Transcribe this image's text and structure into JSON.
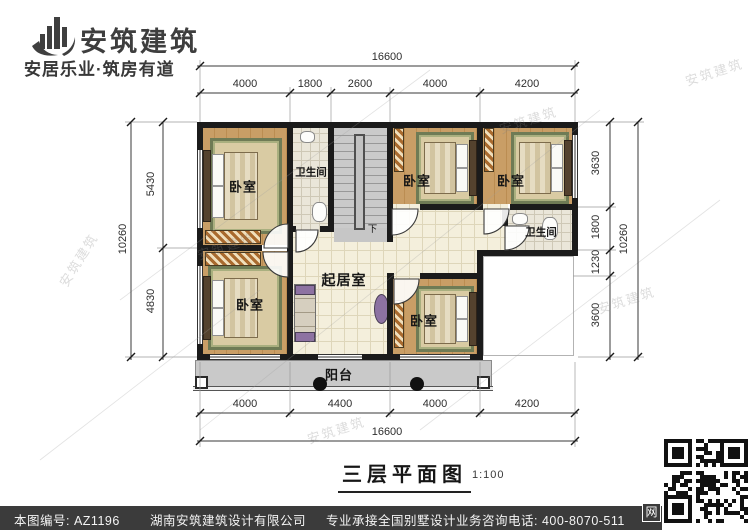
{
  "header": {
    "brand": "安筑建筑",
    "tagline": "安居乐业·筑房有道"
  },
  "rooms": {
    "bedrooms": [
      "卧室",
      "卧室",
      "卧室",
      "卧室",
      "卧室"
    ],
    "bathrooms": [
      "卫生间",
      "卫生间"
    ],
    "living": "起居室",
    "balcony": "阳台",
    "stair_down": "下"
  },
  "dimensions": {
    "top_total": "16600",
    "top_segments": [
      "4000",
      "1800",
      "2600",
      "4000",
      "4200"
    ],
    "bottom_segments": [
      "4000",
      "4400",
      "4000",
      "4200"
    ],
    "bottom_total": "16600",
    "left_total": "10260",
    "left_segments": [
      "5430",
      "4830"
    ],
    "right_segments": [
      "3630",
      "1800",
      "1230",
      "3600"
    ],
    "right_total": "10260"
  },
  "title": {
    "text": "三层平面图",
    "scale": "1:100"
  },
  "footer": {
    "drawing_number": "本图编号: AZ1196",
    "company": "湖南安筑建筑设计有限公司",
    "service": "专业承接全国别墅设计业务",
    "phone": "咨询电话: 400-8070-511",
    "web_badge": "网"
  },
  "watermark": "安筑建筑",
  "colors": {
    "wall": "#1b1b1b",
    "wood_floor": "#c99e66",
    "living_tile": "#f4efdc",
    "bath_tile": "#eae6d9",
    "stair": "#cacaca",
    "balcony": "#c9c9c9",
    "accent_purple": "#8d72a2",
    "rug_border": "#6f7b55",
    "footer_bg": "#3b3b3b"
  }
}
